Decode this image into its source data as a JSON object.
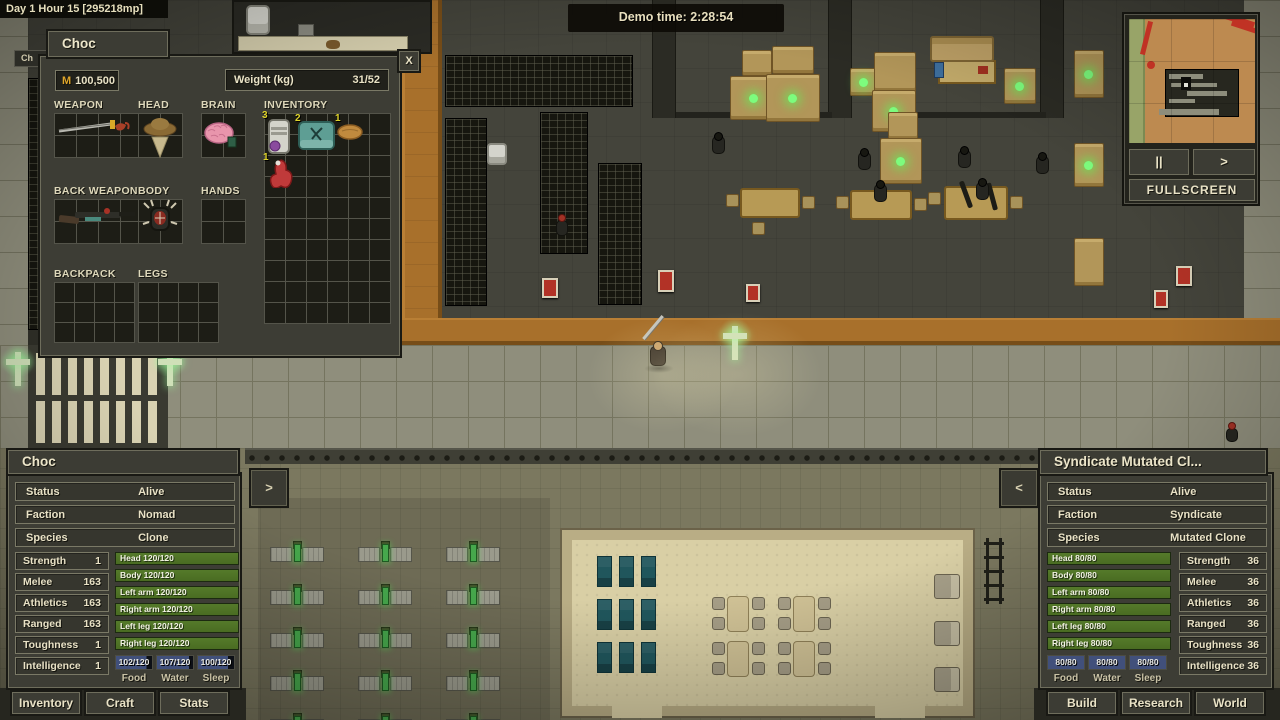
{
  "hud": {
    "clock": "Day 1 Hour 15 [295218mp]",
    "demo_time": "Demo time: 2:28:54",
    "hidden_tab": "Ch",
    "expand_left": ">",
    "collapse_right": "<"
  },
  "minimap": {
    "pause": "||",
    "step": ">",
    "fullscreen": "FULLSCREEN"
  },
  "inventory_window": {
    "tab": "Choc",
    "close": "X",
    "money_currency": "M",
    "money_value": "100,500",
    "weight_label": "Weight (kg)",
    "weight_value": "31/52",
    "sections": {
      "weapon": "WEAPON",
      "head": "HEAD",
      "brain": "BRAIN",
      "inventory": "INVENTORY",
      "back_weapon": "BACK WEAPON",
      "body": "BODY",
      "hands": "HANDS",
      "backpack": "BACKPACK",
      "legs": "LEGS"
    },
    "items": {
      "canister_count": "3",
      "medkit_count": "2",
      "bread_count": "1",
      "organ_count": "1"
    }
  },
  "left_panel": {
    "title": "Choc",
    "info": [
      {
        "label": "Status",
        "value": "Alive"
      },
      {
        "label": "Faction",
        "value": "Nomad"
      },
      {
        "label": "Species",
        "value": "Clone"
      }
    ],
    "stats": [
      {
        "label": "Strength",
        "value": "1"
      },
      {
        "label": "Melee",
        "value": "163"
      },
      {
        "label": "Athletics",
        "value": "163"
      },
      {
        "label": "Ranged",
        "value": "163"
      },
      {
        "label": "Toughness",
        "value": "1"
      },
      {
        "label": "Intelligence",
        "value": "1"
      }
    ],
    "health": [
      "Head 120/120",
      "Body 120/120",
      "Left arm 120/120",
      "Right arm 120/120",
      "Left leg 120/120",
      "Right leg 120/120"
    ],
    "needs": [
      {
        "value": "102/120",
        "label": "Food",
        "fill": 85
      },
      {
        "value": "107/120",
        "label": "Water",
        "fill": 89
      },
      {
        "value": "100/120",
        "label": "Sleep",
        "fill": 83
      }
    ],
    "buttons": [
      "Inventory",
      "Craft",
      "Stats"
    ]
  },
  "right_panel": {
    "title": "Syndicate Mutated Cl...",
    "info": [
      {
        "label": "Status",
        "value": "Alive"
      },
      {
        "label": "Faction",
        "value": "Syndicate"
      },
      {
        "label": "Species",
        "value": "Mutated Clone"
      }
    ],
    "stats": [
      {
        "label": "Strength",
        "value": "36"
      },
      {
        "label": "Melee",
        "value": "36"
      },
      {
        "label": "Athletics",
        "value": "36"
      },
      {
        "label": "Ranged",
        "value": "36"
      },
      {
        "label": "Toughness",
        "value": "36"
      },
      {
        "label": "Intelligence",
        "value": "36"
      }
    ],
    "health": [
      "Head 80/80",
      "Body 80/80",
      "Left arm 80/80",
      "Right arm 80/80",
      "Left leg 80/80",
      "Right leg 80/80"
    ],
    "needs": [
      {
        "value": "80/80",
        "label": "Food",
        "fill": 100
      },
      {
        "value": "80/80",
        "label": "Water",
        "fill": 100
      },
      {
        "value": "80/80",
        "label": "Sleep",
        "fill": 100
      }
    ],
    "buttons": [
      "Build",
      "Research",
      "World"
    ]
  }
}
